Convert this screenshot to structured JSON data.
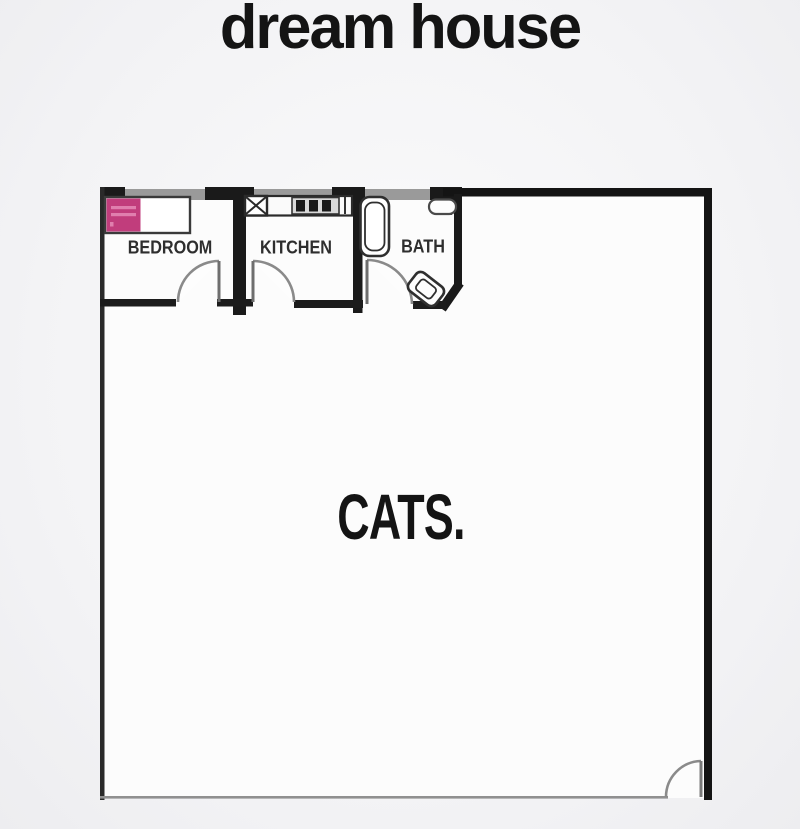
{
  "title": "dream house",
  "floor_plan": {
    "rooms": [
      {
        "id": "bedroom",
        "label": "BEDROOM"
      },
      {
        "id": "kitchen",
        "label": "KITCHEN"
      },
      {
        "id": "bath",
        "label": "BATH"
      },
      {
        "id": "cats",
        "label": "CATS."
      }
    ],
    "fixtures": [
      "bed-with-pink-headboard",
      "kitchen-sink-x-box",
      "kitchen-counter-stove",
      "bathtub",
      "bath-sink",
      "toilet"
    ],
    "doors": [
      "bedroom-door",
      "kitchen-door",
      "bath-door",
      "entry-door"
    ],
    "colors": {
      "wall_black": "#1a1a1a",
      "wall_gray_window": "#9a9a9a",
      "thin_wall_gray": "#909090",
      "door_arc_gray": "#8a8a8a",
      "bed_accent": "#c13d7c",
      "bed_accent_light": "#e07fae",
      "label_color": "#2e2e2e",
      "plan_interior": "#fcfcfc"
    }
  }
}
